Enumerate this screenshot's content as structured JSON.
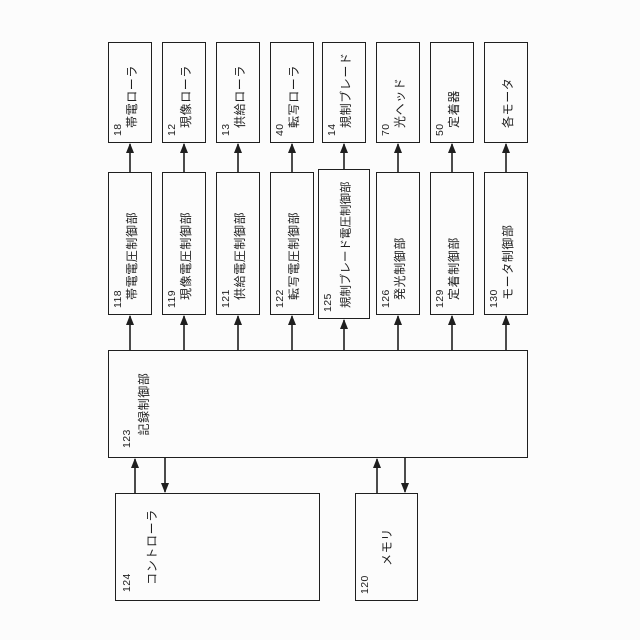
{
  "figure": {
    "kind": "patent block diagram",
    "orientation": "rotated 90deg counter-clockwise, labels read bottom-to-top"
  },
  "colors": {
    "line": "#1f1f1f",
    "background": "#fcfcfc"
  },
  "diagram": {
    "main": {
      "number": "123",
      "label": "記録制御部"
    },
    "controller": {
      "number": "124",
      "label": "コントローラ"
    },
    "memory": {
      "number": "120",
      "label": "メモリ"
    },
    "control_units": [
      {
        "number": "118",
        "label": "帯電電圧制御部"
      },
      {
        "number": "119",
        "label": "現像電圧制御部"
      },
      {
        "number": "121",
        "label": "供給電圧制御部"
      },
      {
        "number": "122",
        "label": "転写電圧制御部"
      },
      {
        "number": "125",
        "label": "規制ブレード電圧制御部"
      },
      {
        "number": "126",
        "label": "発光制御部"
      },
      {
        "number": "129",
        "label": "定着制御部"
      },
      {
        "number": "130",
        "label": "モータ制御部"
      }
    ],
    "devices": [
      {
        "number": "18",
        "label": "帯電ローラ"
      },
      {
        "number": "12",
        "label": "現像ローラ"
      },
      {
        "number": "13",
        "label": "供給ローラ"
      },
      {
        "number": "40",
        "label": "転写ローラ"
      },
      {
        "number": "14",
        "label": "規制ブレード"
      },
      {
        "number": "70",
        "label": "光ヘッド"
      },
      {
        "number": "50",
        "label": "定着器"
      },
      {
        "number": "",
        "label": "各モータ"
      }
    ]
  }
}
